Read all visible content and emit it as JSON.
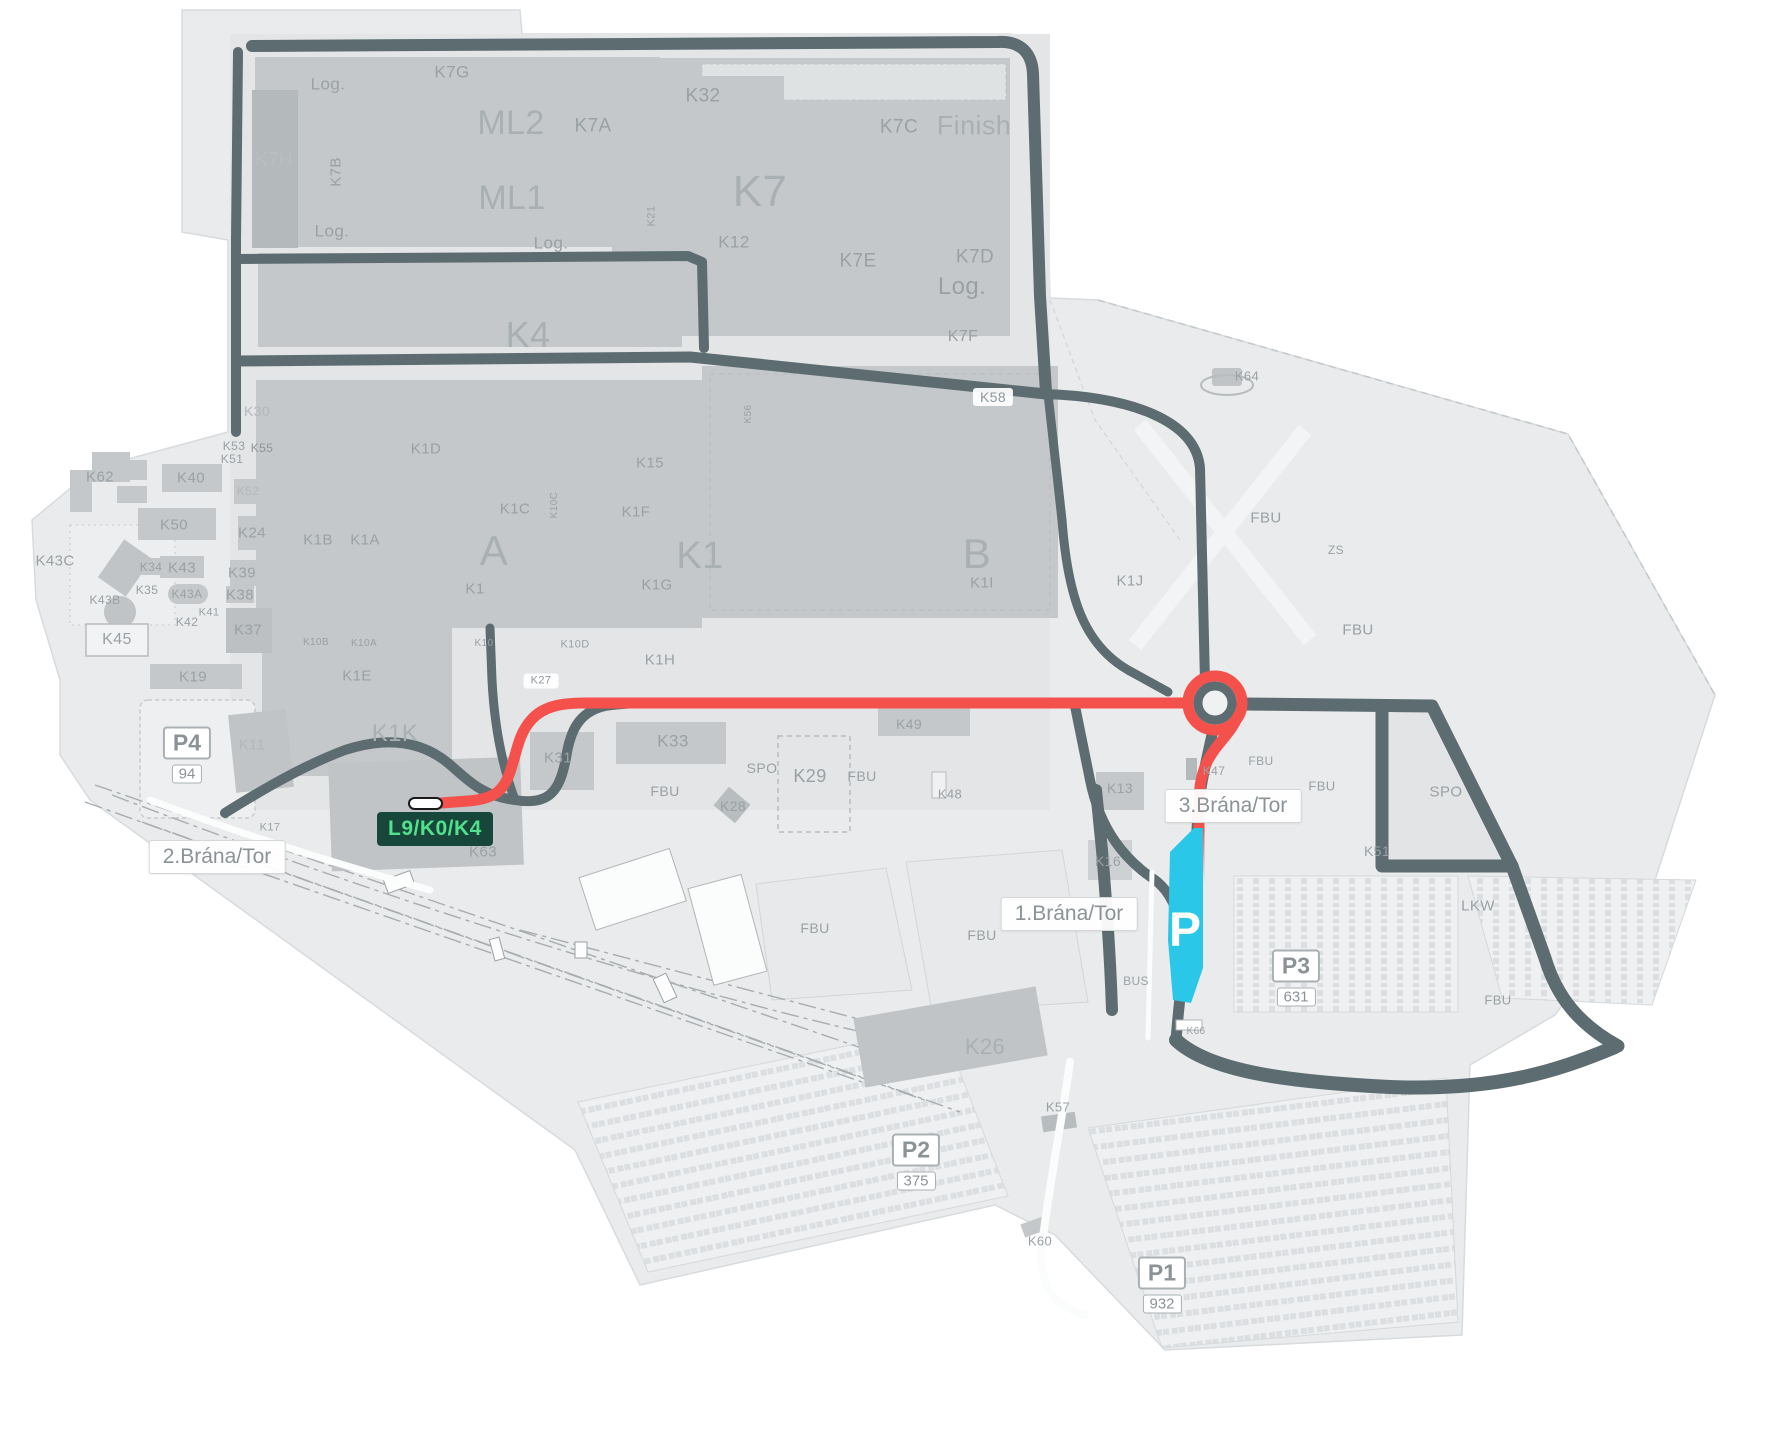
{
  "map": {
    "route_color": "#f4514c",
    "parking_highlight": {
      "letter": "P",
      "color": "#2bc7e8"
    },
    "highlight_badge": {
      "text": "L9/K0/K4",
      "bg": "#17463a",
      "color": "#52e08d"
    },
    "gates": [
      {
        "id": "gate-2",
        "label": "2.Brána/Tor",
        "x": 217,
        "y": 857
      },
      {
        "id": "gate-1",
        "label": "1.Brána/Tor",
        "x": 1069,
        "y": 914
      },
      {
        "id": "gate-3",
        "label": "3.Brána/Tor",
        "x": 1233,
        "y": 806
      }
    ],
    "parkings": [
      {
        "name": "P4",
        "count": "94",
        "x": 187,
        "y": 755
      },
      {
        "name": "P3",
        "count": "631",
        "x": 1296,
        "y": 978
      },
      {
        "name": "P2",
        "count": "375",
        "x": 916,
        "y": 1162
      },
      {
        "name": "P1",
        "count": "932",
        "x": 1162,
        "y": 1285
      }
    ],
    "labels": [
      {
        "t": "Log.",
        "x": 328,
        "y": 84,
        "s": 17
      },
      {
        "t": "K7G",
        "x": 452,
        "y": 72,
        "s": 17
      },
      {
        "t": "ML2",
        "x": 511,
        "y": 123,
        "s": 34,
        "c": "#a9b0b3"
      },
      {
        "t": "K7A",
        "x": 593,
        "y": 126,
        "s": 19
      },
      {
        "t": "K32",
        "x": 703,
        "y": 96,
        "s": 19
      },
      {
        "t": "K7C",
        "x": 899,
        "y": 127,
        "s": 19
      },
      {
        "t": "Finish",
        "x": 974,
        "y": 126,
        "s": 27,
        "c": "#a9b0b3"
      },
      {
        "t": "K7H",
        "x": 274,
        "y": 160,
        "s": 19,
        "c": "#b9bec0"
      },
      {
        "t": "K7B",
        "x": 336,
        "y": 172,
        "s": 15,
        "r": -90
      },
      {
        "t": "ML1",
        "x": 512,
        "y": 198,
        "s": 34,
        "c": "#a9b0b3"
      },
      {
        "t": "K7",
        "x": 760,
        "y": 192,
        "s": 44,
        "c": "#a9b0b3"
      },
      {
        "t": "Log.",
        "x": 332,
        "y": 231,
        "s": 17
      },
      {
        "t": "Log.",
        "x": 551,
        "y": 243,
        "s": 17
      },
      {
        "t": "K21",
        "x": 652,
        "y": 216,
        "s": 11,
        "r": -90
      },
      {
        "t": "K12",
        "x": 734,
        "y": 242,
        "s": 17
      },
      {
        "t": "K7E",
        "x": 858,
        "y": 261,
        "s": 19
      },
      {
        "t": "K7D",
        "x": 975,
        "y": 257,
        "s": 19
      },
      {
        "t": "Log.",
        "x": 962,
        "y": 287,
        "s": 24
      },
      {
        "t": "K4",
        "x": 528,
        "y": 335,
        "s": 36,
        "c": "#a9b0b3"
      },
      {
        "t": "K7F",
        "x": 963,
        "y": 337,
        "s": 16
      },
      {
        "t": "K64",
        "x": 1247,
        "y": 376,
        "s": 13
      },
      {
        "t": "K58",
        "x": 993,
        "y": 397,
        "s": 14,
        "p": true
      },
      {
        "t": "K30",
        "x": 257,
        "y": 411,
        "s": 14,
        "c": "#b2b8ba"
      },
      {
        "t": "K56",
        "x": 749,
        "y": 414,
        "s": 10,
        "r": -90
      },
      {
        "t": "K53",
        "x": 234,
        "y": 446,
        "s": 12
      },
      {
        "t": "K55",
        "x": 262,
        "y": 448,
        "s": 12,
        "c": "#8e969a"
      },
      {
        "t": "K51",
        "x": 232,
        "y": 459,
        "s": 12
      },
      {
        "t": "K1D",
        "x": 426,
        "y": 449,
        "s": 15
      },
      {
        "t": "K15",
        "x": 650,
        "y": 463,
        "s": 15
      },
      {
        "t": "K62",
        "x": 100,
        "y": 477,
        "s": 15
      },
      {
        "t": "K40",
        "x": 191,
        "y": 478,
        "s": 15
      },
      {
        "t": "K52",
        "x": 248,
        "y": 491,
        "s": 12,
        "c": "#b2b8ba"
      },
      {
        "t": "K1C",
        "x": 515,
        "y": 509,
        "s": 15
      },
      {
        "t": "K10C",
        "x": 555,
        "y": 505,
        "s": 10,
        "r": -90
      },
      {
        "t": "K1F",
        "x": 636,
        "y": 512,
        "s": 15
      },
      {
        "t": "FBU",
        "x": 1266,
        "y": 518,
        "s": 15
      },
      {
        "t": "K50",
        "x": 174,
        "y": 525,
        "s": 15
      },
      {
        "t": "K24",
        "x": 252,
        "y": 533,
        "s": 15
      },
      {
        "t": "K1B",
        "x": 318,
        "y": 540,
        "s": 15
      },
      {
        "t": "K1A",
        "x": 365,
        "y": 540,
        "s": 15
      },
      {
        "t": "A",
        "x": 494,
        "y": 551,
        "s": 42,
        "c": "#a9b0b3"
      },
      {
        "t": "K1",
        "x": 700,
        "y": 556,
        "s": 38,
        "c": "#a9b0b3"
      },
      {
        "t": "B",
        "x": 977,
        "y": 554,
        "s": 42,
        "c": "#a9b0b3"
      },
      {
        "t": "ZS",
        "x": 1336,
        "y": 550,
        "s": 12
      },
      {
        "t": "K43C",
        "x": 55,
        "y": 561,
        "s": 15
      },
      {
        "t": "K34",
        "x": 151,
        "y": 567,
        "s": 12
      },
      {
        "t": "K43",
        "x": 182,
        "y": 568,
        "s": 15
      },
      {
        "t": "K39",
        "x": 242,
        "y": 573,
        "s": 15
      },
      {
        "t": "K1I",
        "x": 982,
        "y": 583,
        "s": 15
      },
      {
        "t": "K1J",
        "x": 1130,
        "y": 581,
        "s": 15
      },
      {
        "t": "K1G",
        "x": 657,
        "y": 585,
        "s": 15
      },
      {
        "t": "K1",
        "x": 475,
        "y": 589,
        "s": 15
      },
      {
        "t": "K35",
        "x": 147,
        "y": 590,
        "s": 12
      },
      {
        "t": "K43A",
        "x": 187,
        "y": 594,
        "s": 12
      },
      {
        "t": "K38",
        "x": 240,
        "y": 595,
        "s": 15
      },
      {
        "t": "K43B",
        "x": 105,
        "y": 600,
        "s": 12
      },
      {
        "t": "K41",
        "x": 209,
        "y": 613,
        "s": 11
      },
      {
        "t": "K42",
        "x": 187,
        "y": 622,
        "s": 12
      },
      {
        "t": "K37",
        "x": 248,
        "y": 630,
        "s": 15
      },
      {
        "t": "FBU",
        "x": 1358,
        "y": 630,
        "s": 15
      },
      {
        "t": "K45",
        "x": 117,
        "y": 640,
        "s": 16
      },
      {
        "t": "K10B",
        "x": 316,
        "y": 643,
        "s": 10
      },
      {
        "t": "K10A",
        "x": 364,
        "y": 644,
        "s": 10
      },
      {
        "t": "K10",
        "x": 484,
        "y": 644,
        "s": 10
      },
      {
        "t": "K10D",
        "x": 575,
        "y": 645,
        "s": 11
      },
      {
        "t": "K1H",
        "x": 660,
        "y": 660,
        "s": 15
      },
      {
        "t": "K1E",
        "x": 357,
        "y": 676,
        "s": 15
      },
      {
        "t": "K19",
        "x": 193,
        "y": 677,
        "s": 15
      },
      {
        "t": "K27",
        "x": 541,
        "y": 681,
        "s": 11,
        "p": true
      },
      {
        "t": "K49",
        "x": 909,
        "y": 724,
        "s": 14
      },
      {
        "t": "K1K",
        "x": 395,
        "y": 734,
        "s": 24,
        "c": "#a9b0b3"
      },
      {
        "t": "K33",
        "x": 673,
        "y": 741,
        "s": 17
      },
      {
        "t": "K11",
        "x": 252,
        "y": 745,
        "s": 15,
        "c": "#b2b8ba"
      },
      {
        "t": "K31",
        "x": 558,
        "y": 758,
        "s": 15
      },
      {
        "t": "SPO",
        "x": 762,
        "y": 768,
        "s": 14
      },
      {
        "t": "K29",
        "x": 810,
        "y": 776,
        "s": 18
      },
      {
        "t": "FBU",
        "x": 862,
        "y": 776,
        "s": 14
      },
      {
        "t": "K47",
        "x": 1214,
        "y": 771,
        "s": 12
      },
      {
        "t": "FBU",
        "x": 1261,
        "y": 761,
        "s": 12
      },
      {
        "t": "SPO",
        "x": 1446,
        "y": 792,
        "s": 15
      },
      {
        "t": "FBU",
        "x": 665,
        "y": 791,
        "s": 14
      },
      {
        "t": "K13",
        "x": 1120,
        "y": 788,
        "s": 14
      },
      {
        "t": "FBU",
        "x": 1322,
        "y": 786,
        "s": 13
      },
      {
        "t": "K48",
        "x": 950,
        "y": 794,
        "s": 13
      },
      {
        "t": "K28",
        "x": 733,
        "y": 806,
        "s": 14
      },
      {
        "t": "K17",
        "x": 270,
        "y": 828,
        "s": 11
      },
      {
        "t": "K63",
        "x": 483,
        "y": 852,
        "s": 15
      },
      {
        "t": "K51",
        "x": 1377,
        "y": 851,
        "s": 14
      },
      {
        "t": "K16",
        "x": 1108,
        "y": 861,
        "s": 14
      },
      {
        "t": "LKW",
        "x": 1478,
        "y": 906,
        "s": 15
      },
      {
        "t": "FBU",
        "x": 815,
        "y": 928,
        "s": 14
      },
      {
        "t": "FBU",
        "x": 982,
        "y": 935,
        "s": 14
      },
      {
        "t": "BUS",
        "x": 1136,
        "y": 981,
        "s": 12
      },
      {
        "t": "FBU",
        "x": 1498,
        "y": 1000,
        "s": 13
      },
      {
        "t": "K66",
        "x": 1196,
        "y": 1032,
        "s": 10
      },
      {
        "t": "K26",
        "x": 985,
        "y": 1047,
        "s": 22,
        "c": "#a9b0b3"
      },
      {
        "t": "K57",
        "x": 1058,
        "y": 1107,
        "s": 13
      },
      {
        "t": "K60",
        "x": 1040,
        "y": 1241,
        "s": 13
      }
    ]
  }
}
